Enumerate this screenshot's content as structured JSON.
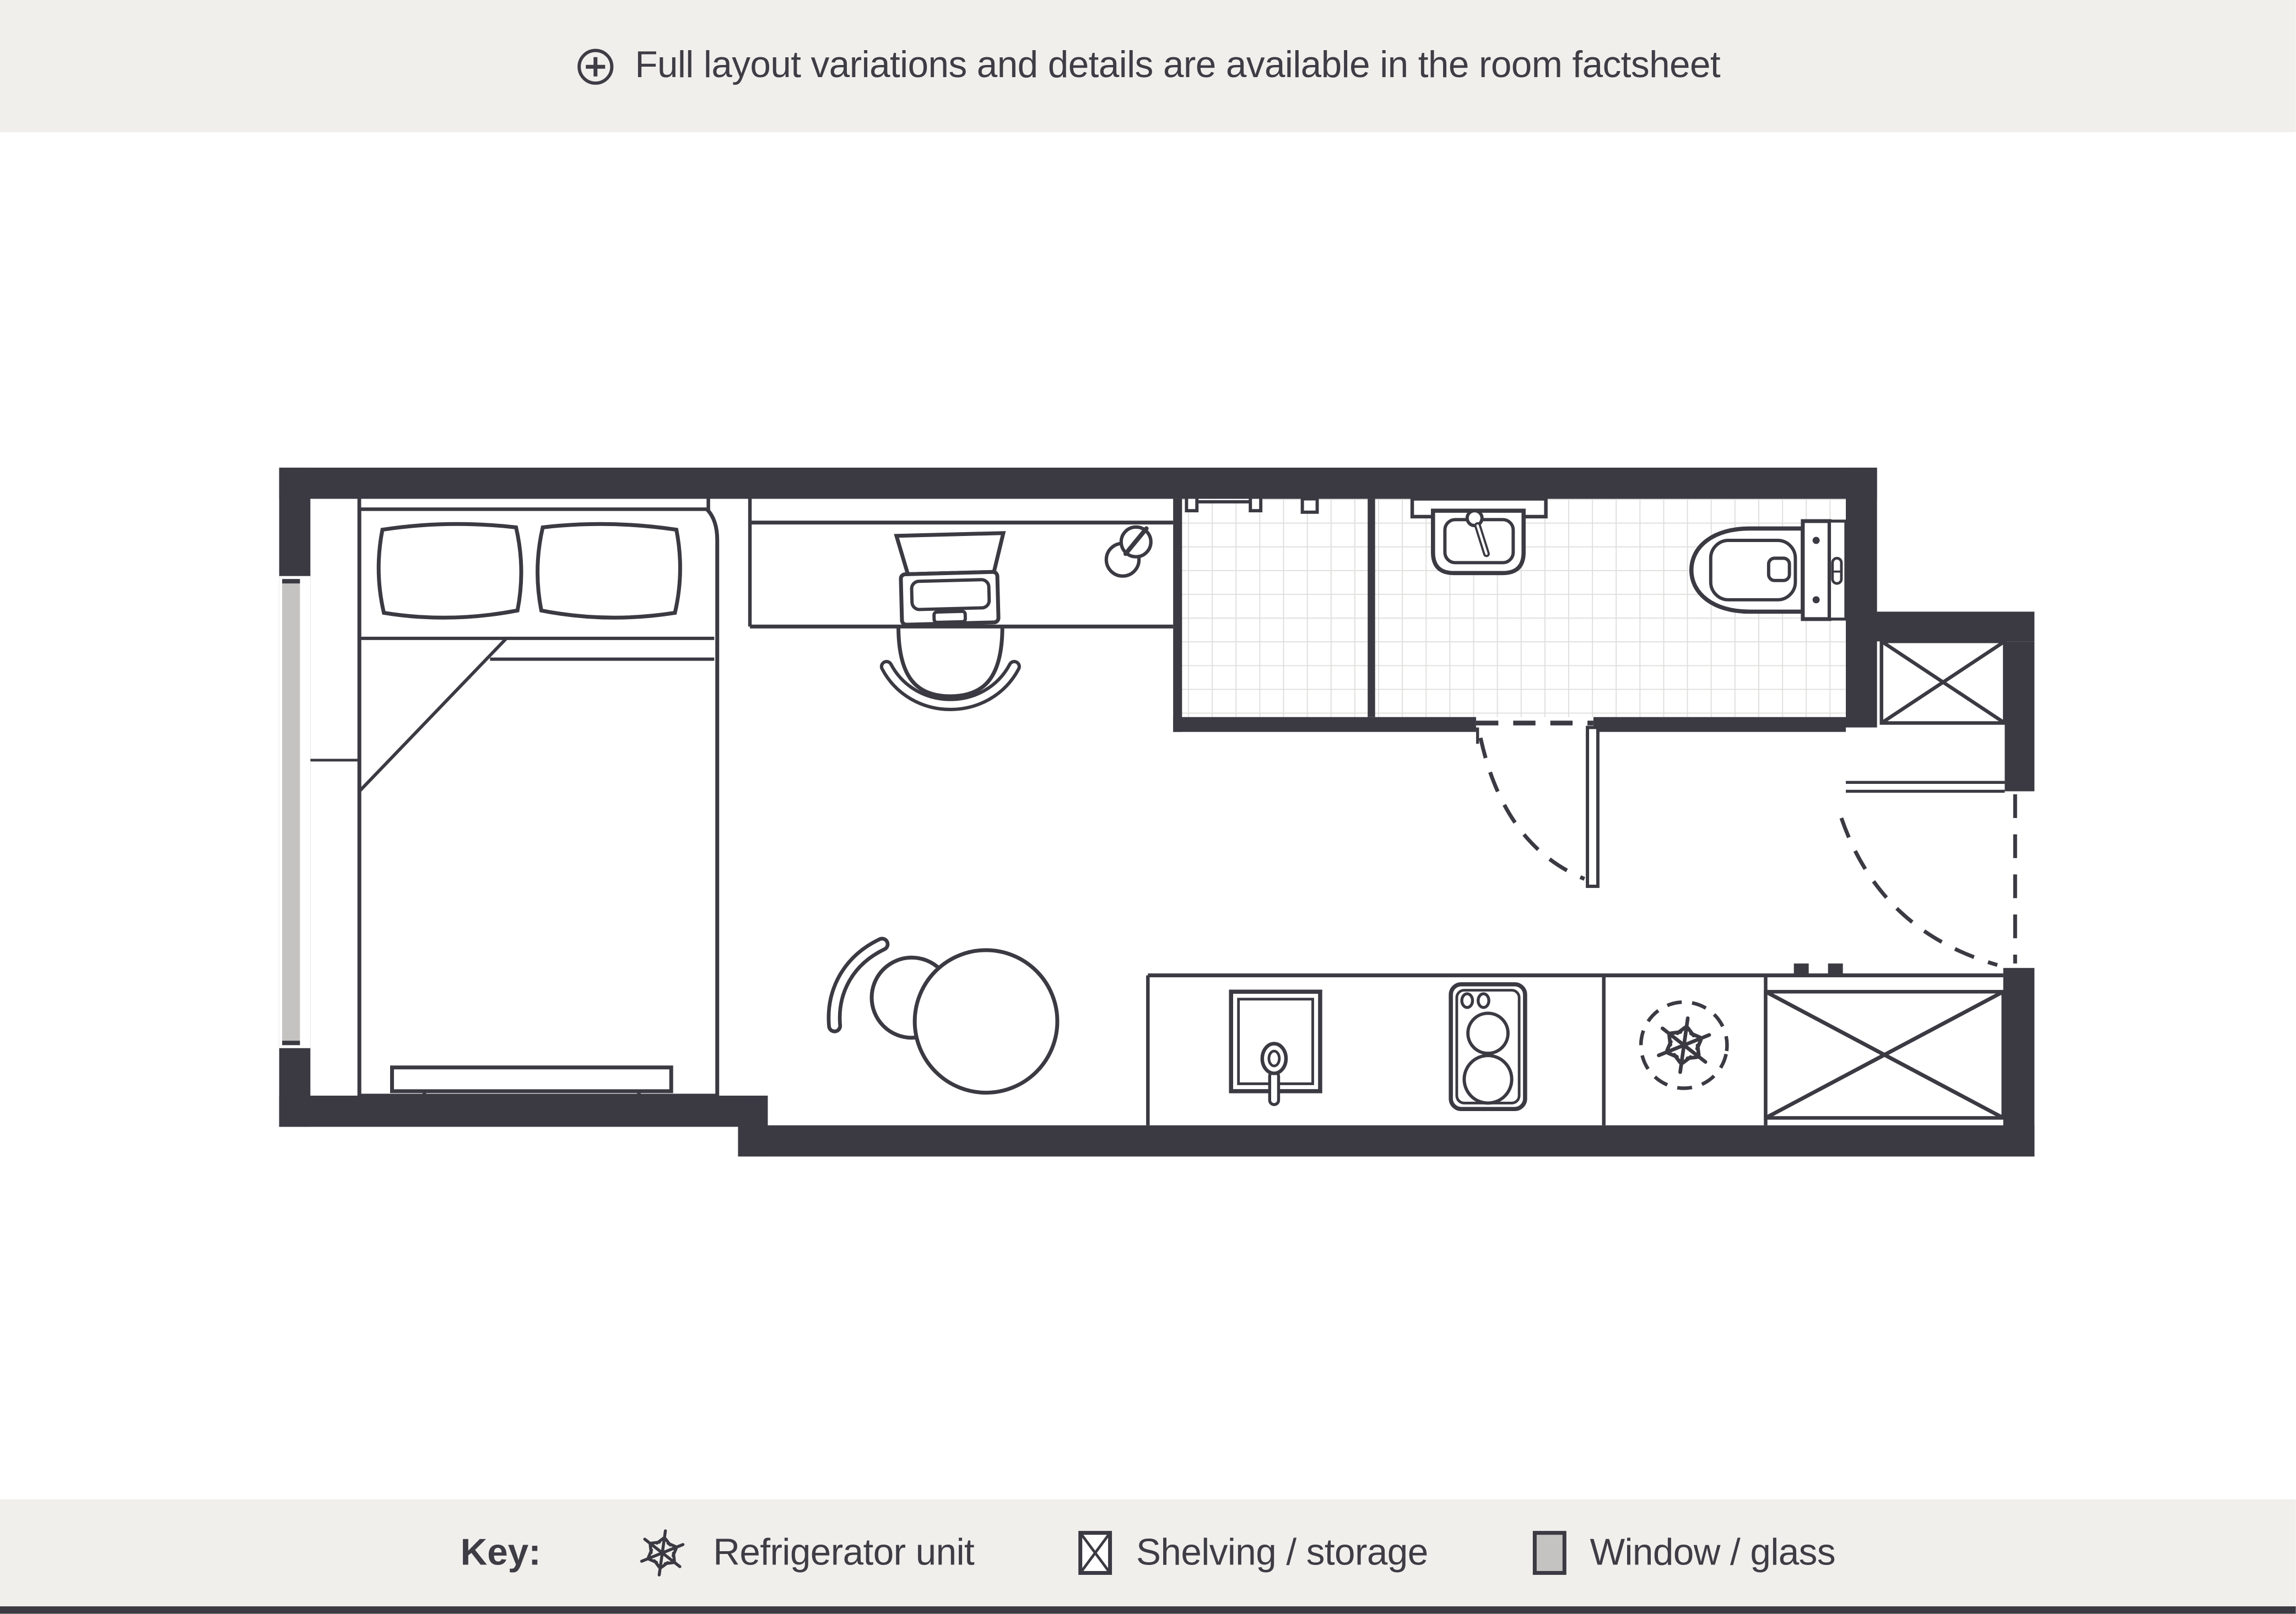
{
  "header": {
    "icon": "plus-circle-icon",
    "notice": "Full layout variations and details are available in the room factsheet"
  },
  "legend": {
    "title": "Key:",
    "items": [
      {
        "icon": "snowflake-icon",
        "label": "Refrigerator unit"
      },
      {
        "icon": "crossed-box-icon",
        "label": "Shelving / storage"
      },
      {
        "icon": "gray-swatch-icon",
        "label": "Window / glass"
      }
    ]
  },
  "floorplan": {
    "type": "studio-room-plan",
    "colors": {
      "wall_ink": "#3b3a43",
      "text": "#3e3d45",
      "panel_background": "#f0efec",
      "tile_line": "#e0dedd",
      "window_glass_gray": "#c5c3c1",
      "floor": "#ffffff"
    },
    "elements": [
      "double-bed",
      "pillows",
      "headboard",
      "duvet-fold",
      "bench-at-bed-foot",
      "window-strip",
      "desk",
      "laptop",
      "desk-lamp",
      "desk-chair",
      "round-table",
      "tub-chair",
      "shower-room-tiled-floor",
      "shower-rail",
      "shower-control",
      "washbasin-vanity",
      "washbasin",
      "toilet",
      "bathroom-door-swing",
      "shelving-niche-crossed-box",
      "entrance-door-swing",
      "kitchen-counter",
      "kitchen-sink",
      "hob-two-burners",
      "refrigerator-snowflake",
      "kitchen-storage-crossed-box"
    ]
  }
}
